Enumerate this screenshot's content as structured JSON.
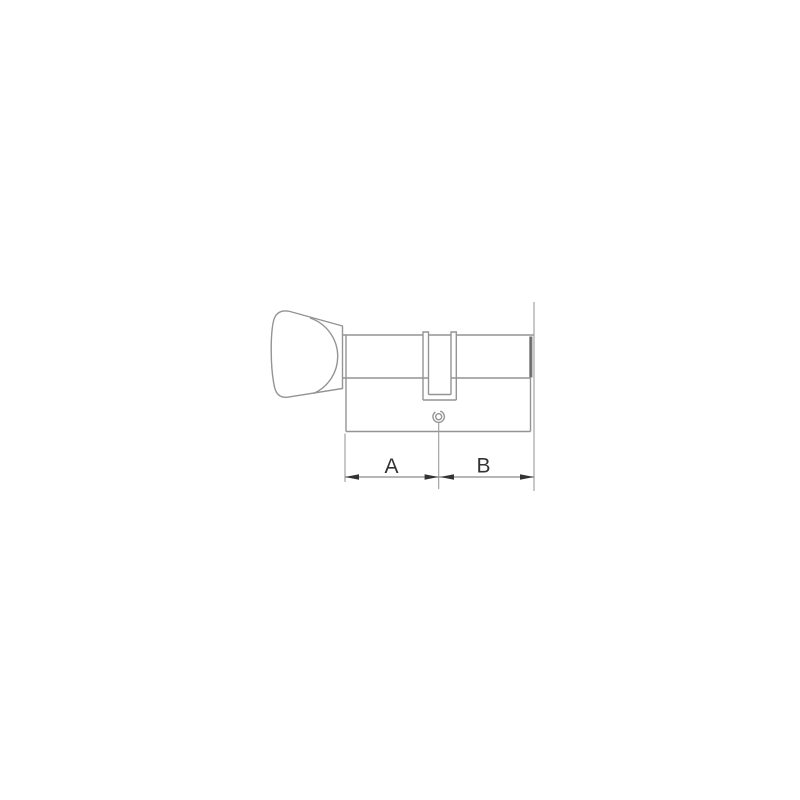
{
  "figure": {
    "kind": "technical-line-drawing",
    "subject": "euro-profile-cylinder-lock-with-thumbturn",
    "dimensions": {
      "a_label": "A",
      "b_label": "B"
    },
    "colors": {
      "background": "#ffffff",
      "outline": "#949494",
      "dimension_lines": "#8a8a8a",
      "arrows_and_text": "#333333",
      "barrel_end_shading": "#5f5f5f"
    },
    "parts": [
      "thumbturn-knob",
      "knob-face-curve",
      "cylinder-barrel",
      "cylinder-body",
      "cam-slot",
      "screw-hole",
      "center-extension-line",
      "left-extension-line",
      "right-extension-line",
      "dimension-line"
    ]
  }
}
